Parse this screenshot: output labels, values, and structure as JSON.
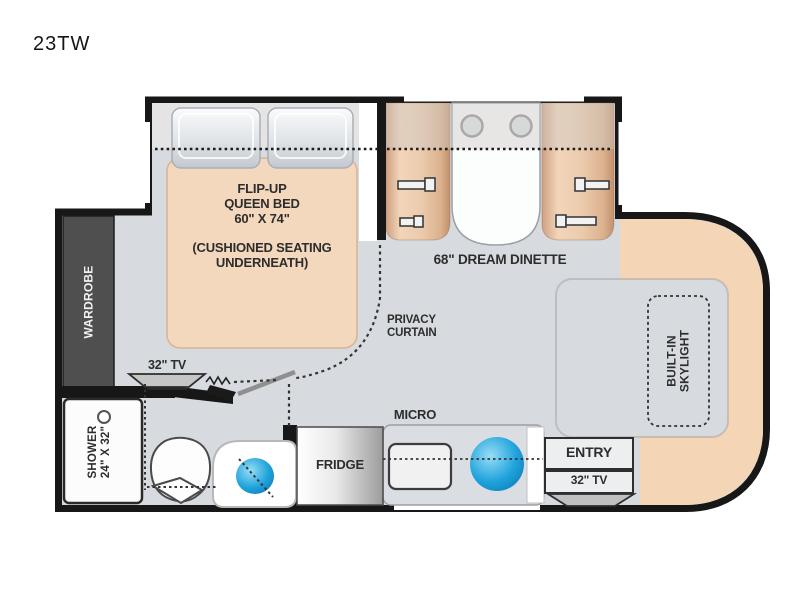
{
  "model_label": "23TW",
  "colors": {
    "floor": "#d7dbe0",
    "wall": "#171717",
    "cab_accent_tan": "#f4d6b6",
    "bed_tan": "#f3d8bd",
    "bench_tan": "#edcbb0",
    "wardrobe_gray": "#4f4f4f",
    "sink_blue": "#29a8dc"
  },
  "labels": {
    "bed": "FLIP-UP\nQUEEN BED\n60\" X 74\"",
    "bed_sub": "(CUSHIONED SEATING\nUNDERNEATH)",
    "dinette": "68\" DREAM DINETTE",
    "wardrobe": "WARDROBE",
    "bedroom_tv": "32\" TV",
    "privacy_curtain": "PRIVACY\nCURTAIN",
    "shower": "SHOWER\n24\" X 32\"",
    "micro": "MICRO",
    "fridge": "FRIDGE",
    "entry": "ENTRY",
    "living_tv": "32\" TV",
    "skylight": "BUILT-IN\nSKYLIGHT"
  }
}
